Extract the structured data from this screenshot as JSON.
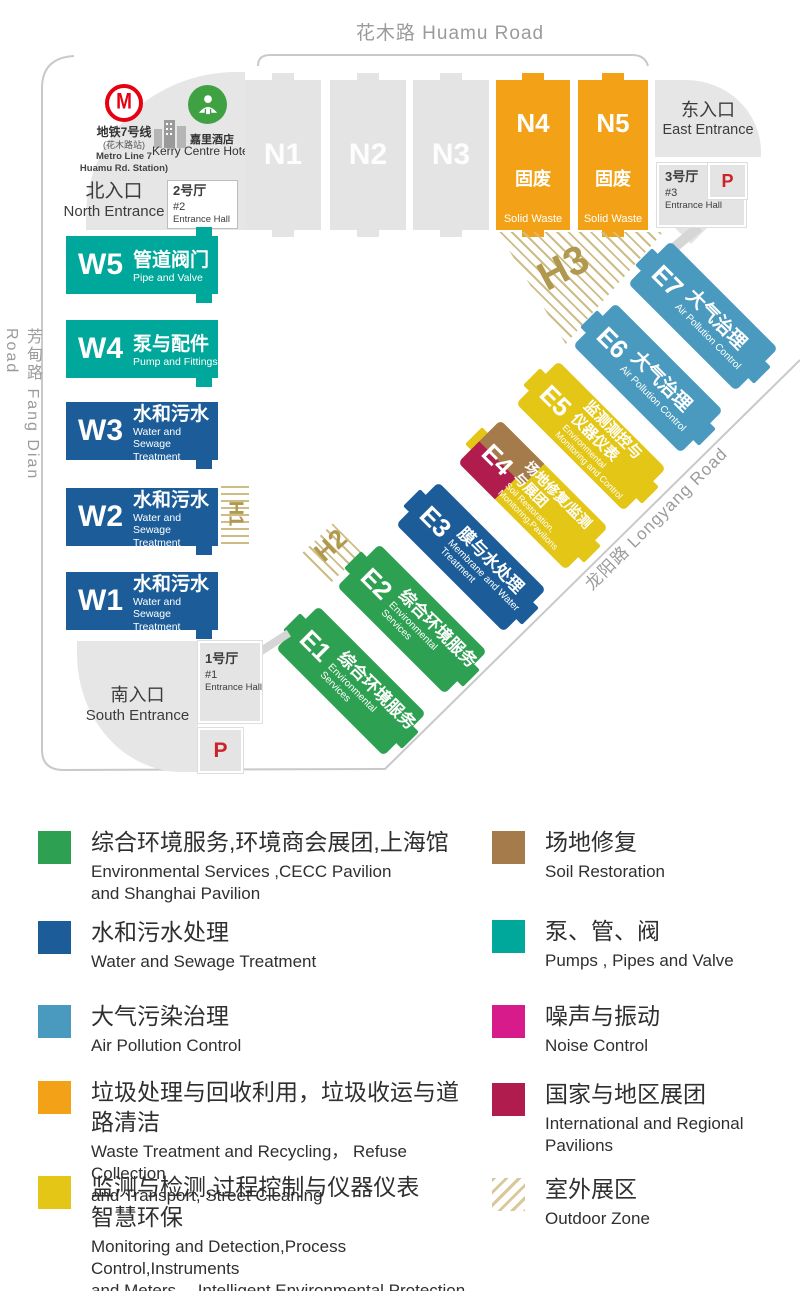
{
  "roads": {
    "top": "花木路 Huamu Road",
    "left": "芳甸路 Fang Dian Road",
    "right": "龙阳路  Longyang Road"
  },
  "north": {
    "metro_line1": "地铁7号线",
    "metro_line2": "(花木路站)",
    "metro_line3": "Metro Line 7",
    "metro_line4": "Huamu Rd. Station)",
    "metro_logo_letter": "M",
    "hotel_cn": "嘉里酒店",
    "hotel_en": "Kerry Centre Hotel",
    "entrance_cn": "北入口",
    "entrance_en": "North Entrance",
    "hall_cn": "2号厅",
    "hall_num": "#2",
    "hall_en": "Entrance Hall"
  },
  "east": {
    "entrance_cn": "东入口",
    "entrance_en": "East Entrance",
    "hall_cn": "3号厅",
    "hall_num": "#3",
    "hall_en": "Entrance Hall",
    "parking": "P"
  },
  "south": {
    "entrance_cn": "南入口",
    "entrance_en": "South Entrance",
    "hall_cn": "1号厅",
    "hall_num": "#1",
    "hall_en": "Entrance Hall",
    "parking": "P"
  },
  "halls_n": [
    {
      "id": "N1"
    },
    {
      "id": "N2"
    },
    {
      "id": "N3"
    },
    {
      "id": "N4",
      "cn": "固废",
      "en": "Solid Waste"
    },
    {
      "id": "N5",
      "cn": "固废",
      "en": "Solid Waste"
    }
  ],
  "halls_w": [
    {
      "id": "W5",
      "cn": "管道阀门",
      "en": "Pipe and Valve"
    },
    {
      "id": "W4",
      "cn": "泵与配件",
      "en": "Pump and Fittings"
    },
    {
      "id": "W3",
      "cn": "水和污水",
      "en": "Water and Sewage\nTreatment"
    },
    {
      "id": "W2",
      "cn": "水和污水",
      "en": "Water and Sewage\nTreatment"
    },
    {
      "id": "W1",
      "cn": "水和污水",
      "en": "Water and Sewage\nTreatment"
    }
  ],
  "halls_e": [
    {
      "id": "E1",
      "cn": "综合环境服务",
      "en": "Environmental\nServices"
    },
    {
      "id": "E2",
      "cn": "综合环境服务",
      "en": "Environmental\nServices"
    },
    {
      "id": "E3",
      "cn": "膜与水处理",
      "en": "Membrane and Water\nTreatment"
    },
    {
      "id": "E4",
      "cn": "场地修复/监测\n与展团",
      "en": "Soil Restoration,\nMonitoring,Pavilions"
    },
    {
      "id": "E5",
      "cn": "监测测控与\n仪器仪表",
      "en": "Environmental\nMonitoring and Control"
    },
    {
      "id": "E6",
      "cn": "大气治理",
      "en": "Air Pollution Control"
    },
    {
      "id": "E7",
      "cn": "大气治理",
      "en": "Air Pollution Control"
    }
  ],
  "outdoor_zones": {
    "h1": "H1",
    "h2": "H2",
    "h3": "H3"
  },
  "legend_left": [
    {
      "color_key": "green",
      "cn": "综合环境服务,环境商会展团,上海馆",
      "en": "Environmental Services ,CECC Pavilion\nand Shanghai Pavilion"
    },
    {
      "color_key": "blue",
      "cn": "水和污水处理",
      "en": "Water and Sewage Treatment"
    },
    {
      "color_key": "air_blue",
      "cn": "大气污染治理",
      "en": "Air Pollution Control"
    },
    {
      "color_key": "orange",
      "cn": "垃圾处理与回收利用，垃圾收运与道路清洁",
      "en": "Waste Treatment and Recycling， Refuse Collection\nand Transport, Street Cleaning"
    },
    {
      "color_key": "yellow",
      "cn": "监测与检测,过程控制与仪器仪表\n智慧环保",
      "en": "Monitoring and Detection,Process Control,Instruments\nand Meters， Intelligent Environmental Protection"
    }
  ],
  "legend_right": [
    {
      "color_key": "brown",
      "cn": "场地修复",
      "en": "Soil Restoration"
    },
    {
      "color_key": "teal",
      "cn": "泵、管、阀",
      "en": "Pumps , Pipes and Valve"
    },
    {
      "color_key": "magenta",
      "cn": "噪声与振动",
      "en": "Noise Control"
    },
    {
      "color_key": "crimson",
      "cn": "国家与地区展团",
      "en": "International and Regional Pavilions"
    },
    {
      "color_key": "hatch",
      "cn": "室外展区",
      "en": "Outdoor Zone"
    }
  ],
  "colors": {
    "green": "#2ea052",
    "blue": "#1c5d99",
    "air_blue": "#4a9abf",
    "orange": "#f3a218",
    "yellow": "#e4c617",
    "teal": "#00a79b",
    "brown": "#a57b4c",
    "crimson": "#b01c4e",
    "magenta": "#d81b8a",
    "gray_hall": "#e4e4e4",
    "outdoor_gold": "#b0994f",
    "metro_red": "#e60012",
    "hotel_green": "#3fa142",
    "parking_red": "#cc2229",
    "road_gray": "#9b9b9b"
  }
}
